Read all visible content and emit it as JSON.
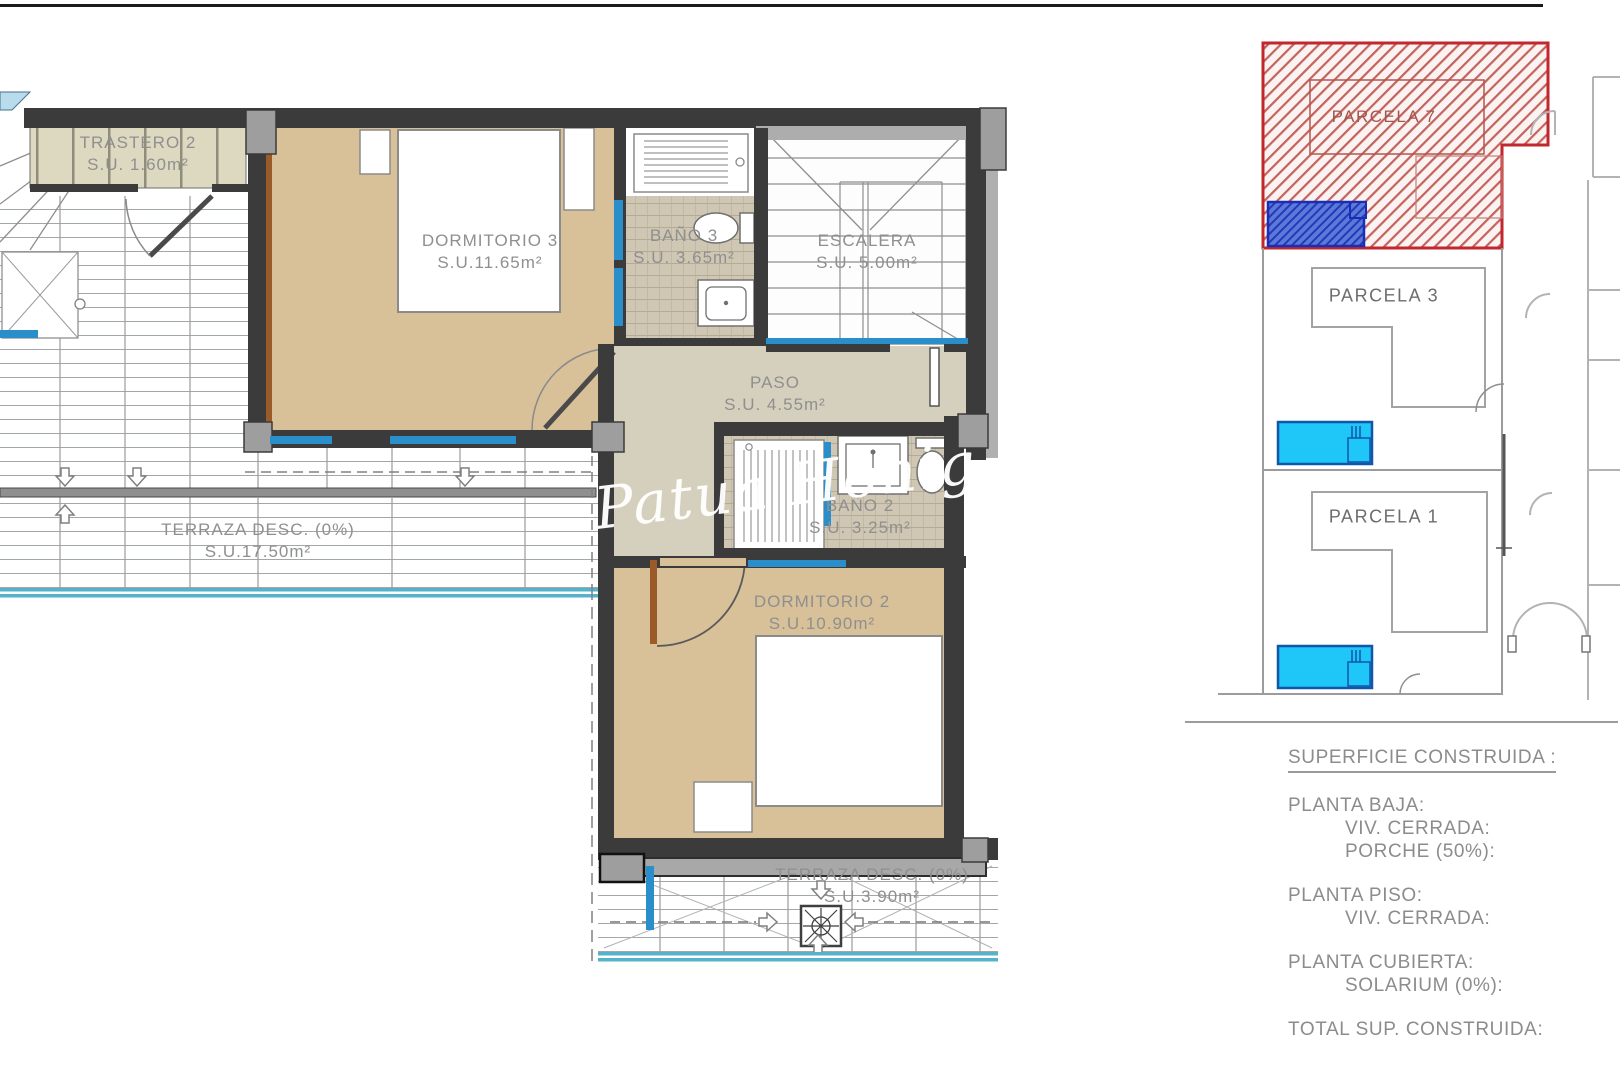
{
  "floor_plan": {
    "rooms": [
      {
        "name": "TRASTERO 2",
        "area": "S.U. 1.60m²"
      },
      {
        "name": "DORMITORIO 3",
        "area": "S.U.11.65m²"
      },
      {
        "name": "BAÑO 3",
        "area": "S.U. 3.65m²"
      },
      {
        "name": "ESCALERA",
        "area": "S.U. 5.00m²"
      },
      {
        "name": "PASO",
        "area": "S.U. 4.55m²"
      },
      {
        "name": "BAÑO 2",
        "area": "S.U. 3.25m²"
      },
      {
        "name": "TERRAZA DESC. (0%)",
        "area": "S.U.17.50m²"
      },
      {
        "name": "DORMITORIO 2",
        "area": "S.U.10.90m²"
      },
      {
        "name": "TERRAZA DESC. (0%)",
        "area": "S.U.3.90m²"
      }
    ],
    "watermark": "Patua Honig"
  },
  "site_plan": {
    "parcels": [
      {
        "label": "PARCELA 7"
      },
      {
        "label": "PARCELA 3"
      },
      {
        "label": "PARCELA 1"
      }
    ]
  },
  "legend": {
    "title": "SUPERFICIE CONSTRUIDA :",
    "sections": [
      {
        "heading": "PLANTA BAJA:",
        "items": [
          "VIV. CERRADA:",
          "PORCHE (50%):"
        ]
      },
      {
        "heading": "PLANTA PISO:",
        "items": [
          "VIV. CERRADA:"
        ]
      },
      {
        "heading": "PLANTA CUBIERTA:",
        "items": [
          "SOLARIUM (0%):"
        ]
      }
    ],
    "total": "TOTAL SUP. CONSTRUIDA:"
  },
  "colors": {
    "room_tan": "#d8c199",
    "room_greige": "#d5cfbd",
    "tile_floor": "#cfc7b3",
    "wall_dark": "#3b3b3b",
    "wall_gray": "#a8a8a8",
    "window_blue": "#2a8ecb",
    "railing_teal": "#55b2c8",
    "parcel_red": "#c1272d",
    "pool_cyan": "#1ec7f7",
    "pool_border": "#1156a8",
    "hatch_blue": "#2438b8",
    "label_gray": "#8f8f8f"
  }
}
